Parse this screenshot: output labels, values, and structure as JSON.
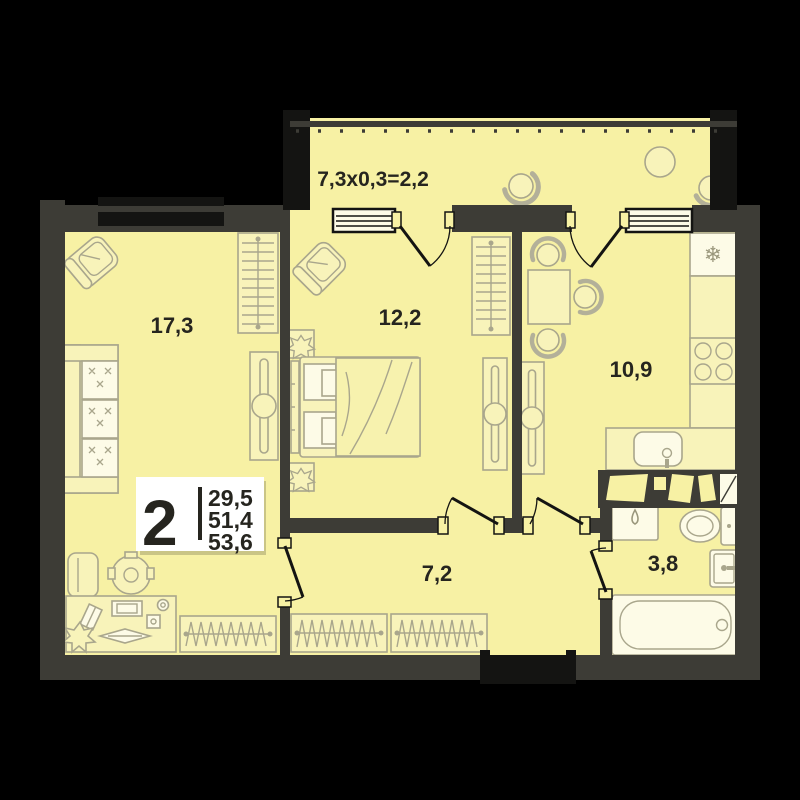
{
  "plan": {
    "badge": {
      "rooms_count": "2",
      "area_living": "29,5",
      "area_main": "51,4",
      "area_total": "53,6"
    },
    "balcony_label": "7,3x0,3=2,2",
    "rooms": {
      "living": "17,3",
      "bedroom": "12,2",
      "kitchen": "10,9",
      "hallway": "7,2",
      "bathroom": "3,8"
    },
    "icons": {
      "snowflake": "❄"
    },
    "colors": {
      "background": "#000000",
      "wall": "#3d3c36",
      "floor": "#f7f1a4",
      "furniture_line": "#a9a68c",
      "text": "#26251f",
      "badge_background": "#ffffff"
    }
  }
}
